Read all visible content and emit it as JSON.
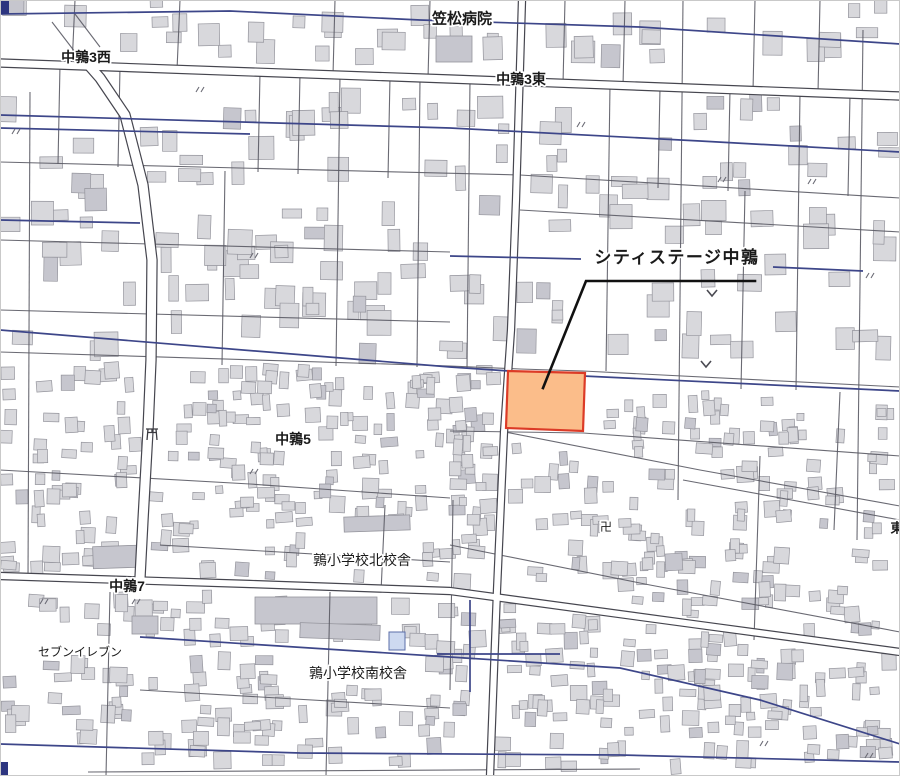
{
  "map": {
    "width": 900,
    "height": 776,
    "palette": {
      "background": "#ffffff",
      "frame": "#c9c9c9",
      "building_fill": "#d8d8dc",
      "building_dark": "#c6c6ce",
      "building_stroke": "#94949c",
      "minor_road": "#5a5a64",
      "major_road_casing": "#46464f",
      "major_road_fill": "#ffffff",
      "canal": "#3d4689",
      "highlight_fill": "#fbbd8a",
      "highlight_stroke": "#dc3b27",
      "leader": "#111111",
      "label_color": "#1a1a1a",
      "label_halo": "#ffffff",
      "corner_mark": "#2d3580",
      "pool_fill": "#cdd9f0",
      "pool_stroke": "#5b6ea8",
      "symbol_color": "#4a4a52"
    },
    "labels": [
      {
        "id": "kasamatsu-hospital",
        "text": "笠松病院",
        "x": 462,
        "y": 18,
        "size": 15,
        "weight": 600
      },
      {
        "id": "nakauzura-3-west",
        "text": "中鶉3西",
        "x": 86,
        "y": 57,
        "size": 14,
        "weight": 600
      },
      {
        "id": "nakauzura-3-east",
        "text": "中鶉3東",
        "x": 521,
        "y": 79,
        "size": 14,
        "weight": 600
      },
      {
        "id": "nakauzura-5",
        "text": "中鶉5",
        "x": 293,
        "y": 439,
        "size": 14,
        "weight": 700
      },
      {
        "id": "uzura-school-north",
        "text": "鶉小学校北校舎",
        "x": 362,
        "y": 560,
        "size": 14,
        "weight": 500
      },
      {
        "id": "nakauzura-7",
        "text": "中鶉7",
        "x": 127,
        "y": 586,
        "size": 14,
        "weight": 700
      },
      {
        "id": "seven-eleven",
        "text": "セブンイレブン",
        "x": 80,
        "y": 652,
        "size": 12,
        "weight": 400
      },
      {
        "id": "uzura-school-south",
        "text": "鶉小学校南校舎",
        "x": 358,
        "y": 673,
        "size": 14,
        "weight": 500
      },
      {
        "id": "higashi-partial",
        "text": "東",
        "x": 897,
        "y": 528,
        "size": 13,
        "weight": 600
      }
    ],
    "annotation": {
      "id": "city-stage-nakauzura",
      "text": "シティステージ中鶉",
      "x": 677,
      "y": 263,
      "size": 17,
      "weight": 700,
      "leader": [
        [
          755,
          281
        ],
        [
          586,
          281
        ],
        [
          543,
          388
        ]
      ]
    },
    "highlight_parcel": {
      "points": [
        [
          508,
          371
        ],
        [
          585,
          373
        ],
        [
          583,
          431
        ],
        [
          506,
          428
        ]
      ]
    },
    "major_roads": [
      {
        "name": "nakauzura-3-road",
        "w": 7,
        "points": [
          [
            0,
            63
          ],
          [
            450,
            79
          ],
          [
            900,
            96
          ]
        ]
      },
      {
        "name": "nakauzura-7-road",
        "w": 6,
        "points": [
          [
            0,
            576
          ],
          [
            250,
            584
          ],
          [
            450,
            591
          ],
          [
            700,
            625
          ],
          [
            900,
            652
          ]
        ]
      },
      {
        "name": "center-vertical-road",
        "w": 6,
        "points": [
          [
            522,
            0
          ],
          [
            516,
            200
          ],
          [
            511,
            330
          ],
          [
            504,
            432
          ],
          [
            497,
            590
          ],
          [
            490,
            776
          ]
        ]
      },
      {
        "name": "west-diagonal-road",
        "w": 9,
        "points": [
          [
            86,
            62
          ],
          [
            100,
            78
          ],
          [
            125,
            115
          ],
          [
            143,
            185
          ],
          [
            152,
            260
          ],
          [
            151,
            360
          ],
          [
            148,
            430
          ],
          [
            143,
            520
          ],
          [
            140,
            578
          ]
        ]
      }
    ],
    "minor_roads": [
      [
        [
          0,
          162
        ],
        [
          520,
          175
        ],
        [
          900,
          198
        ]
      ],
      [
        [
          0,
          240
        ],
        [
          450,
          252
        ]
      ],
      [
        [
          520,
          210
        ],
        [
          900,
          232
        ]
      ],
      [
        [
          0,
          310
        ],
        [
          450,
          322
        ]
      ],
      [
        [
          0,
          352
        ],
        [
          450,
          366
        ],
        [
          520,
          369
        ],
        [
          583,
          371
        ],
        [
          900,
          387
        ]
      ],
      [
        [
          450,
          431
        ],
        [
          583,
          433
        ],
        [
          900,
          456
        ]
      ],
      [
        [
          0,
          470
        ],
        [
          250,
          484
        ],
        [
          450,
          498
        ]
      ],
      [
        [
          160,
          545
        ],
        [
          450,
          562
        ]
      ],
      [
        [
          140,
          690
        ],
        [
          450,
          708
        ]
      ],
      [
        [
          88,
          772
        ],
        [
          640,
          769
        ]
      ],
      [
        [
          505,
          432
        ],
        [
          700,
          470
        ],
        [
          900,
          506
        ]
      ],
      [
        [
          450,
          545
        ],
        [
          650,
          585
        ],
        [
          900,
          632
        ]
      ],
      [
        [
          683,
          480
        ],
        [
          900,
          520
        ]
      ],
      [
        [
          75,
          0
        ],
        [
          72,
          66
        ]
      ],
      [
        [
          180,
          0
        ],
        [
          177,
          70
        ]
      ],
      [
        [
          335,
          0
        ],
        [
          333,
          75
        ]
      ],
      [
        [
          430,
          0
        ],
        [
          428,
          79
        ]
      ],
      [
        [
          565,
          0
        ],
        [
          563,
          84
        ]
      ],
      [
        [
          625,
          0
        ],
        [
          623,
          86
        ]
      ],
      [
        [
          755,
          0
        ],
        [
          753,
          91
        ]
      ],
      [
        [
          820,
          0
        ],
        [
          818,
          93
        ]
      ],
      [
        [
          60,
          65
        ],
        [
          58,
          164
        ]
      ],
      [
        [
          120,
          67
        ],
        [
          118,
          167
        ]
      ],
      [
        [
          260,
          73
        ],
        [
          258,
          172
        ]
      ],
      [
        [
          300,
          74
        ],
        [
          298,
          174
        ]
      ],
      [
        [
          390,
          77
        ],
        [
          388,
          178
        ]
      ],
      [
        [
          470,
          80
        ],
        [
          467,
          369
        ]
      ],
      [
        [
          610,
          85
        ],
        [
          606,
          371
        ]
      ],
      [
        [
          660,
          88
        ],
        [
          658,
          188
        ]
      ],
      [
        [
          730,
          90
        ],
        [
          728,
          191
        ]
      ],
      [
        [
          800,
          93
        ],
        [
          796,
          390
        ]
      ],
      [
        [
          850,
          95
        ],
        [
          848,
          196
        ]
      ],
      [
        [
          30,
          92
        ],
        [
          28,
          580
        ]
      ],
      [
        [
          225,
          171
        ],
        [
          222,
          365
        ]
      ],
      [
        [
          340,
          75
        ],
        [
          336,
          366
        ]
      ],
      [
        [
          420,
          79
        ],
        [
          417,
          367
        ]
      ],
      [
        [
          683,
          0
        ],
        [
          678,
          500
        ]
      ],
      [
        [
          745,
          191
        ],
        [
          741,
          389
        ]
      ],
      [
        [
          863,
          30
        ],
        [
          857,
          540
        ]
      ],
      [
        [
          110,
          592
        ],
        [
          106,
          776
        ]
      ],
      [
        [
          330,
          592
        ],
        [
          326,
          776
        ]
      ],
      [
        [
          385,
          505
        ],
        [
          381,
          592
        ]
      ],
      [
        [
          453,
          500
        ],
        [
          450,
          690
        ]
      ],
      [
        [
          760,
          456
        ],
        [
          754,
          640
        ]
      ],
      [
        [
          840,
          392
        ],
        [
          834,
          530
        ]
      ],
      [
        [
          52,
          22
        ],
        [
          75,
          52
        ]
      ],
      [
        [
          75,
          14
        ],
        [
          100,
          47
        ]
      ]
    ],
    "canals": [
      [
        [
          0,
          14
        ],
        [
          230,
          11
        ],
        [
          420,
          20
        ],
        [
          640,
          27
        ],
        [
          900,
          44
        ]
      ],
      [
        [
          0,
          115
        ],
        [
          450,
          128
        ],
        [
          700,
          141
        ],
        [
          900,
          152
        ]
      ],
      [
        [
          0,
          128
        ],
        [
          250,
          134
        ]
      ],
      [
        [
          0,
          220
        ],
        [
          140,
          223
        ]
      ],
      [
        [
          450,
          256
        ],
        [
          581,
          259
        ]
      ],
      [
        [
          773,
          267
        ],
        [
          863,
          271
        ]
      ],
      [
        [
          0,
          330
        ],
        [
          450,
          367
        ],
        [
          583,
          376
        ],
        [
          900,
          391
        ]
      ],
      [
        [
          140,
          637
        ],
        [
          450,
          657
        ],
        [
          620,
          668
        ],
        [
          760,
          700
        ],
        [
          900,
          744
        ]
      ],
      [
        [
          0,
          744
        ],
        [
          300,
          753
        ],
        [
          620,
          755
        ],
        [
          900,
          762
        ]
      ],
      [
        [
          470,
          600
        ],
        [
          470,
          692
        ]
      ],
      [
        [
          437,
          654
        ],
        [
          560,
          654
        ]
      ]
    ],
    "special_buildings": [
      [
        436,
        36,
        36,
        26,
        0
      ],
      [
        93,
        546,
        44,
        22,
        -2
      ],
      [
        344,
        516,
        66,
        15,
        -2
      ],
      [
        255,
        597,
        122,
        27,
        0
      ],
      [
        300,
        624,
        80,
        15,
        2
      ],
      [
        132,
        616,
        26,
        18,
        0
      ]
    ],
    "building_zones": [
      {
        "x": 4,
        "y": 2,
        "w": 892,
        "h": 56,
        "n": 40,
        "smin": 10,
        "smax": 24,
        "rot": 4
      },
      {
        "x": 4,
        "y": 100,
        "w": 892,
        "h": 258,
        "n": 150,
        "smin": 9,
        "smax": 26,
        "rot": 4
      },
      {
        "x": 4,
        "y": 368,
        "w": 496,
        "h": 210,
        "n": 210,
        "smin": 7,
        "smax": 17,
        "rot": 10
      },
      {
        "x": 455,
        "y": 392,
        "w": 441,
        "h": 380,
        "n": 320,
        "smin": 7,
        "smax": 17,
        "rot": 10
      },
      {
        "x": 4,
        "y": 596,
        "w": 446,
        "h": 170,
        "n": 130,
        "smin": 8,
        "smax": 18,
        "rot": 8
      }
    ],
    "field_chevrons": [
      [
        712,
        293
      ],
      [
        706,
        364
      ]
    ],
    "ditto_marks": [
      [
        12,
        134
      ],
      [
        196,
        92
      ],
      [
        250,
        258
      ],
      [
        577,
        127
      ],
      [
        718,
        182
      ],
      [
        808,
        184
      ],
      [
        866,
        278
      ],
      [
        40,
        604
      ],
      [
        132,
        604
      ],
      [
        250,
        474
      ],
      [
        760,
        746
      ],
      [
        865,
        758
      ]
    ],
    "temple_mark": {
      "symbol": "卍",
      "x": 606,
      "y": 531
    },
    "torii_mark": {
      "x": 152,
      "y": 434
    },
    "pool": {
      "x": 389,
      "y": 632,
      "w": 16,
      "h": 18
    },
    "corner_marks": [
      [
        0,
        0,
        9,
        14
      ],
      [
        0,
        762,
        8,
        14
      ]
    ]
  }
}
